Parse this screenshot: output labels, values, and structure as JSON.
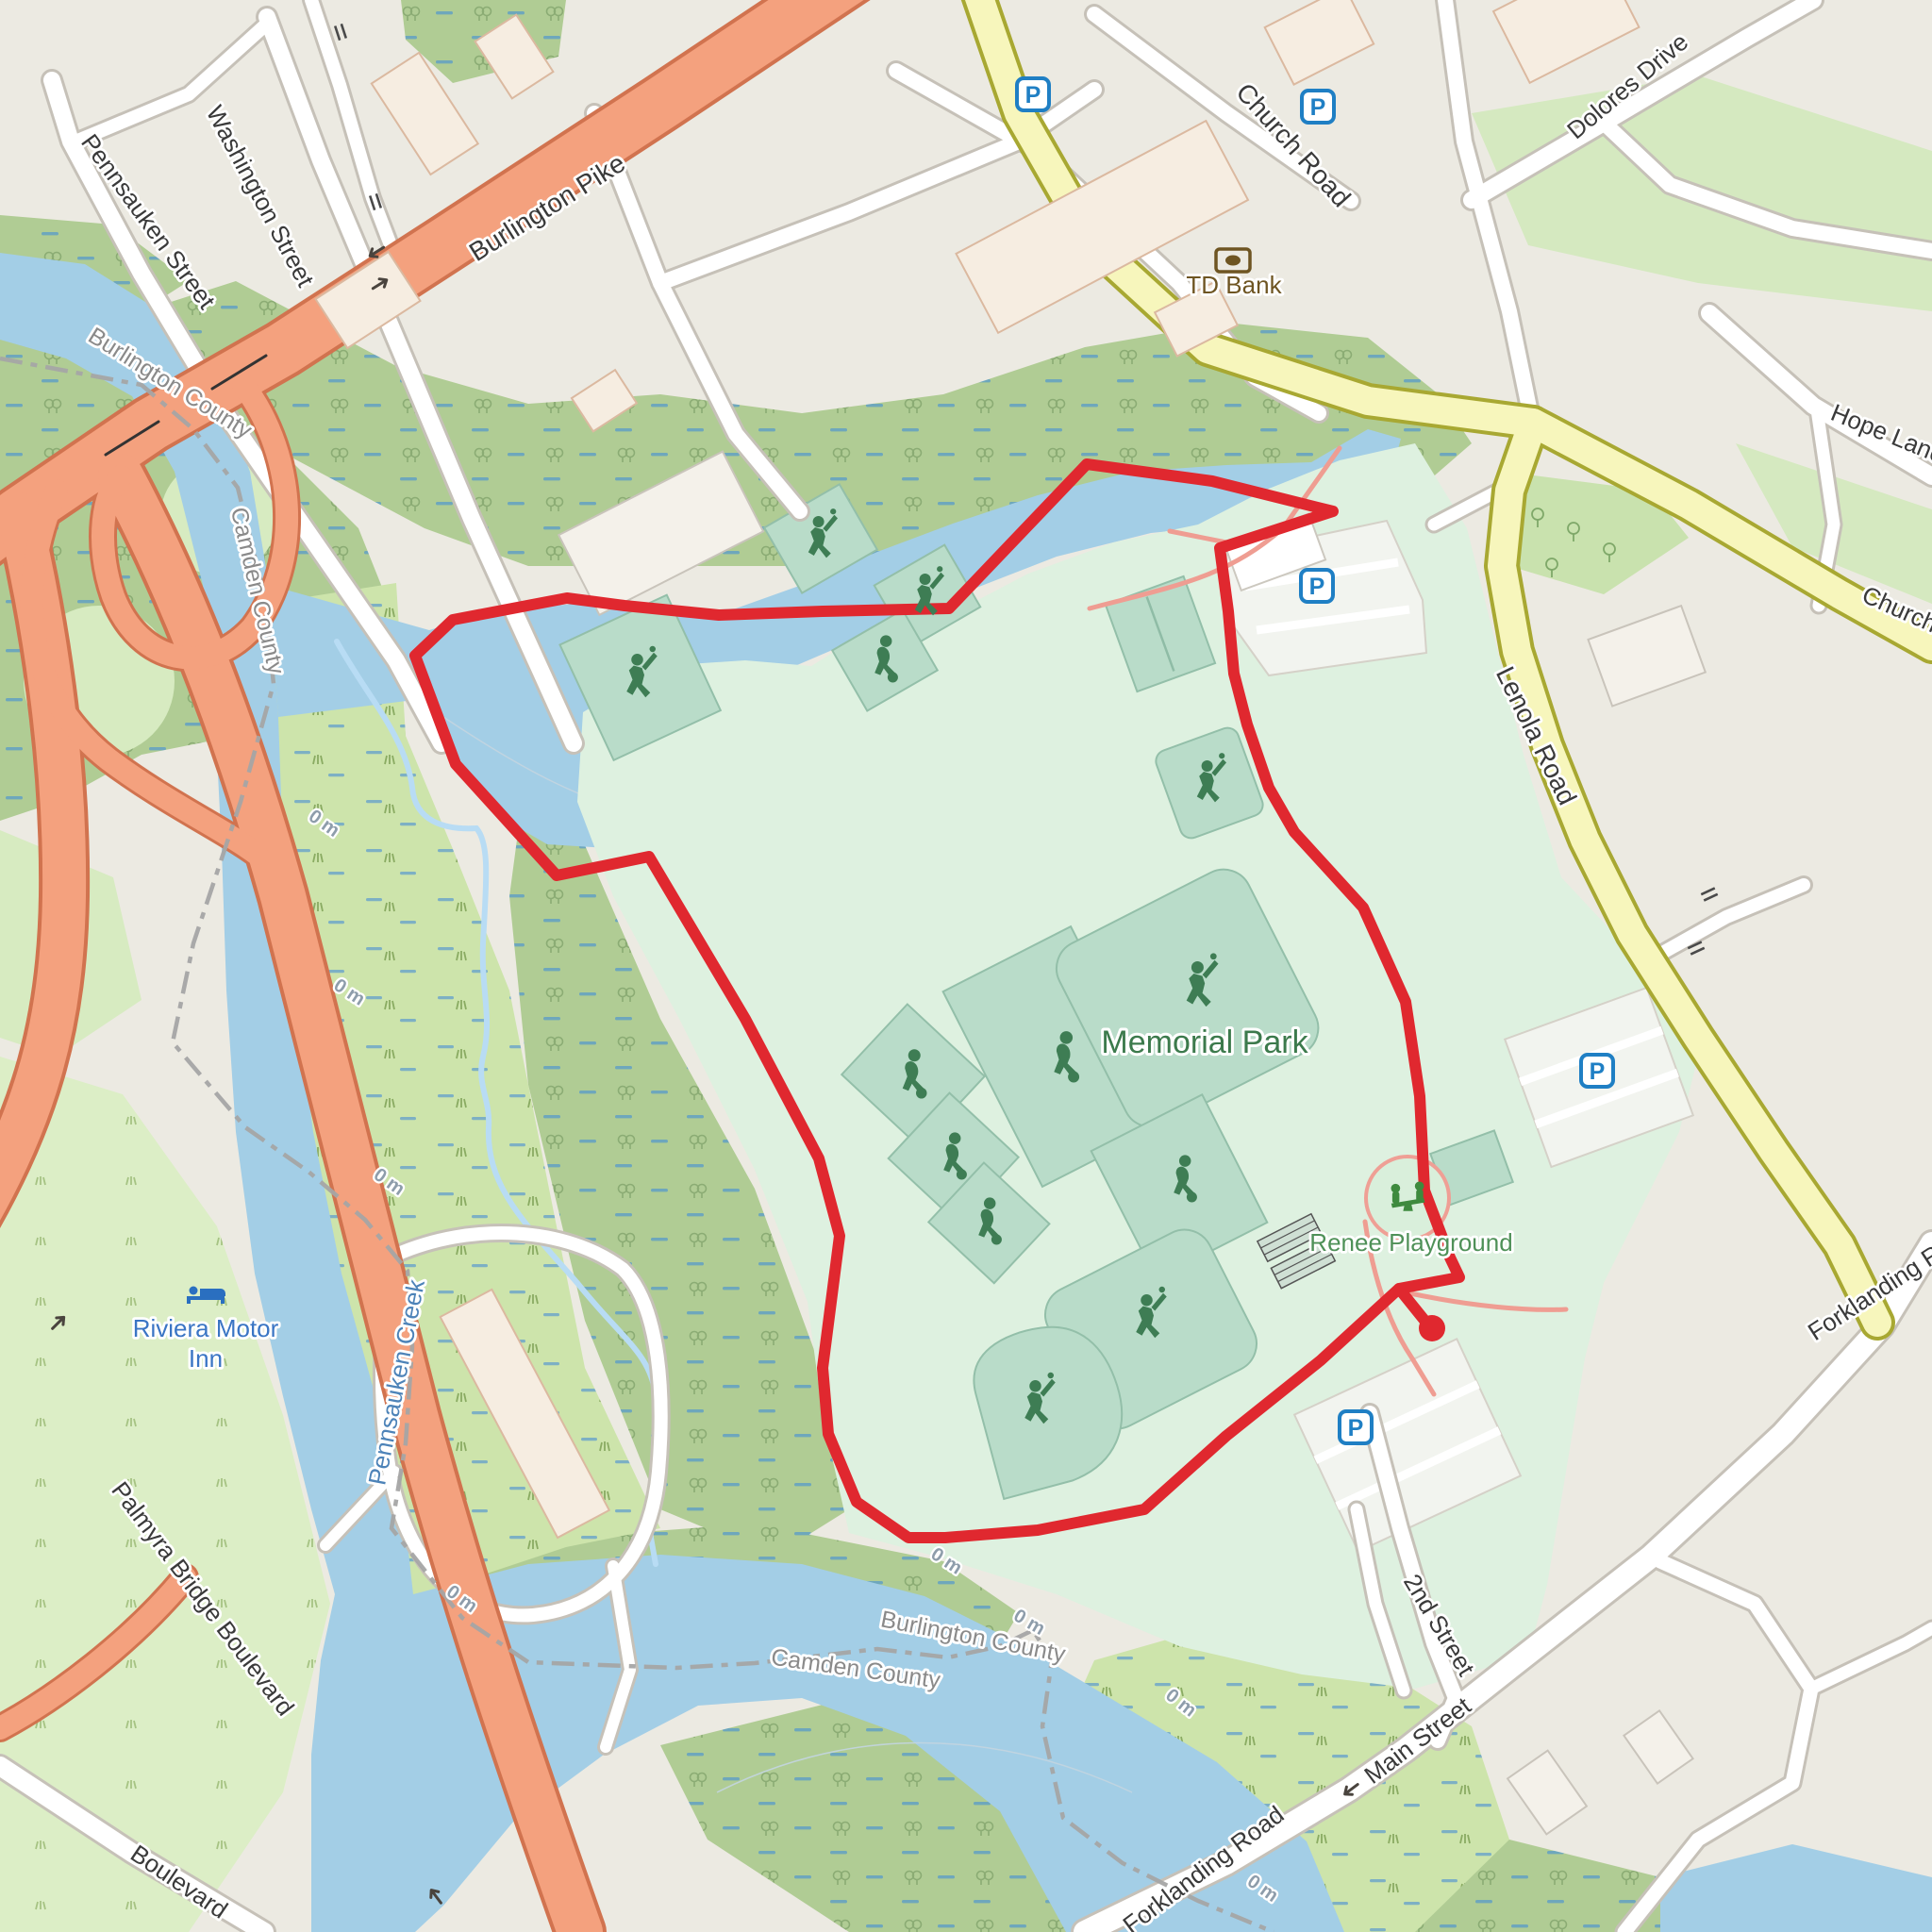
{
  "map_labels": {
    "roads": {
      "burlington_pike": "Burlington Pike",
      "pennsauken_street": "Pennsauken Street",
      "washington_street": "Washington Street",
      "church_road": "Church Road",
      "church_road_east": "Church Road",
      "dolores_drive": "Dolores Drive",
      "hope_lane": "Hope Lane",
      "lenola_road": "Lenola Road",
      "palmyra_bridge_boulevard": "Palmyra Bridge Boulevard",
      "boulevard": "Boulevard",
      "main_street": "Main Street",
      "second_street": "2nd Street",
      "forklanding_road": "Forklanding Road",
      "forklanding_road_east": "Forklanding Road"
    },
    "places": {
      "memorial_park": "Memorial Park",
      "renee_playground": "Renee Playground",
      "td_bank": "TD Bank",
      "riviera_motor_inn_line1": "Riviera Motor",
      "riviera_motor_inn_line2": "Inn"
    },
    "water": {
      "pennsauken_creek": "Pennsauken Creek"
    },
    "boundaries": {
      "burlington_county_nw": "Burlington County",
      "camden_county_nw": "Camden County",
      "burlington_county_s": "Burlington County",
      "camden_county_s": "Camden County"
    },
    "elevation": {
      "zero": "0 m"
    },
    "icons": {
      "parking_letter": "P"
    }
  },
  "colors": {
    "water": "#a3cee6",
    "park_green": "#def1e0",
    "pitch_green": "#b9dcc9",
    "pictogram_green": "#3e7d54",
    "wetland_green": "#b0cc94",
    "marsh_green": "#cde4ab",
    "trunk_orange": "#f4a17e",
    "secondary_yellow": "#f7f6bc",
    "track_red": "#e0282f",
    "parking_blue": "#1f7fc4",
    "boundary_gray": "#a5a5a5"
  }
}
